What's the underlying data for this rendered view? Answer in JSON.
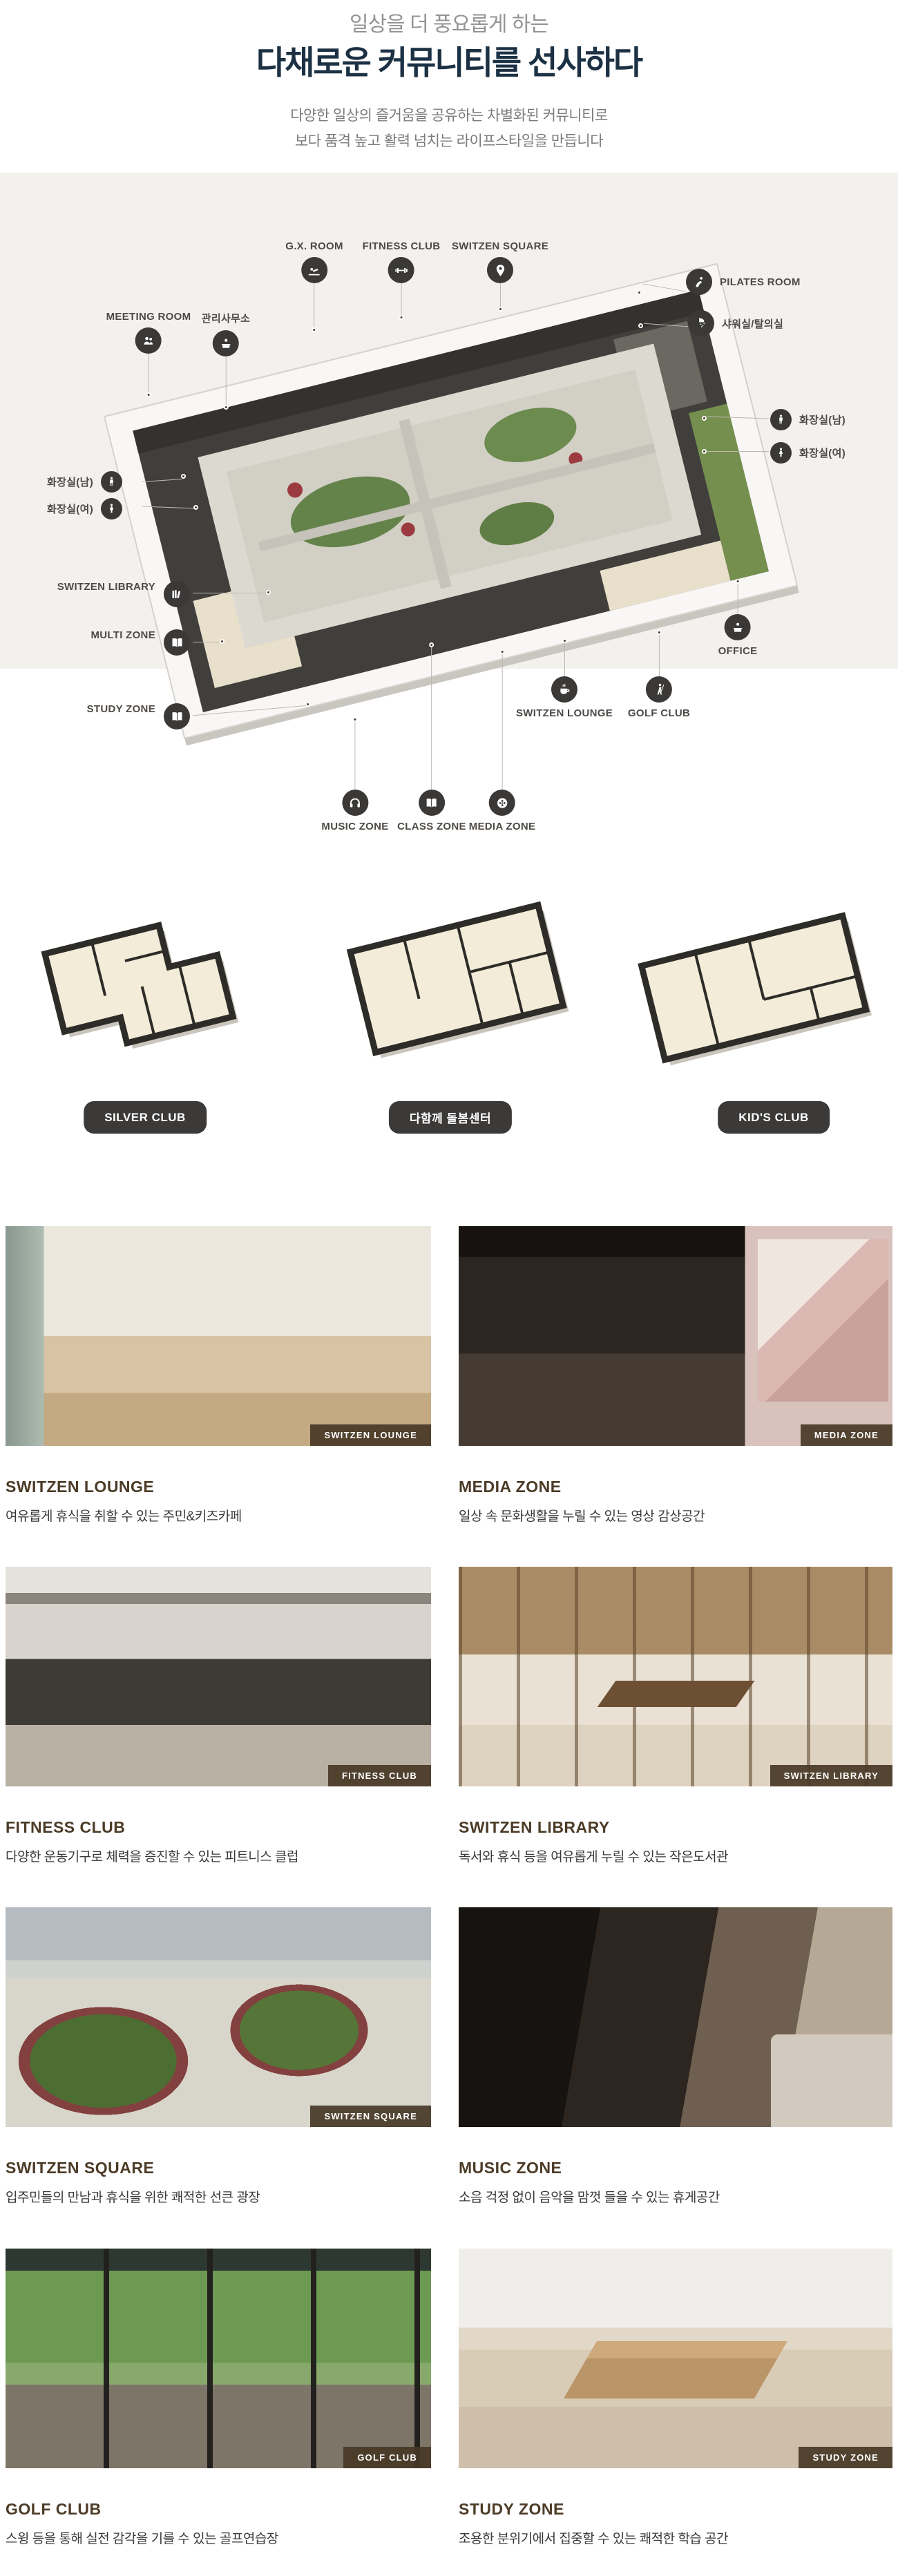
{
  "header": {
    "subtitle": "일상을 더 풍요롭게 하는",
    "title": "다채로운 커뮤니티를 선사하다",
    "description_line1": "다양한 일상의 즐거움을 공유하는 차별화된 커뮤니티로",
    "description_line2": "보다 품격 높고 활력 넘치는 라이프스타일을 만듭니다"
  },
  "colors": {
    "accent_navy": "#1c3144",
    "section_bg": "#f2f1ee",
    "icon_circle": "#3b3937",
    "badge_brown": "#483826",
    "title_brown": "#4c3b27"
  },
  "floorplan": {
    "labels": [
      {
        "text": "G.X. ROOM",
        "icon": "gx-room-icon"
      },
      {
        "text": "FITNESS CLUB",
        "icon": "dumbbell-icon"
      },
      {
        "text": "SWITZEN SQUARE",
        "icon": "location-pin-icon"
      },
      {
        "text": "PILATES ROOM",
        "icon": "pilates-icon"
      },
      {
        "text": "샤워실/탈의실",
        "icon": "shower-icon"
      },
      {
        "text": "MEETING ROOM",
        "icon": "people-icon"
      },
      {
        "text": "관리사무소",
        "icon": "reception-desk-icon"
      },
      {
        "text": "화장실(남)",
        "icon": "male-icon"
      },
      {
        "text": "화장실(여)",
        "icon": "female-icon"
      },
      {
        "text": "화장실(남)",
        "icon": "male-icon"
      },
      {
        "text": "화장실(여)",
        "icon": "female-icon"
      },
      {
        "text": "SWITZEN LIBRARY",
        "icon": "books-icon"
      },
      {
        "text": "MULTI ZONE",
        "icon": "open-book-icon"
      },
      {
        "text": "STUDY ZONE",
        "icon": "open-book-icon"
      },
      {
        "text": "OFFICE",
        "icon": "reception-desk-icon"
      },
      {
        "text": "SWITZEN LOUNGE",
        "icon": "coffee-cup-icon"
      },
      {
        "text": "GOLF CLUB",
        "icon": "golfer-icon"
      },
      {
        "text": "MUSIC ZONE",
        "icon": "headphones-icon"
      },
      {
        "text": "CLASS ZONE",
        "icon": "open-book-icon"
      },
      {
        "text": "MEDIA ZONE",
        "icon": "film-reel-icon"
      }
    ]
  },
  "clubs": [
    {
      "label": "SILVER CLUB"
    },
    {
      "label": "다함께 돌봄센터"
    },
    {
      "label": "KID'S CLUB"
    }
  ],
  "gallery": [
    {
      "badge": "SWITZEN LOUNGE",
      "title": "SWITZEN LOUNGE",
      "desc": "여유롭게 휴식을 취할 수 있는 주민&키즈카페"
    },
    {
      "badge": "MEDIA ZONE",
      "title": "MEDIA ZONE",
      "desc": "일상 속 문화생활을 누릴 수 있는 영상 감상공간"
    },
    {
      "badge": "FITNESS CLUB",
      "title": "FITNESS CLUB",
      "desc": "다양한 운동기구로 체력을 증진할 수 있는 피트니스 클럽"
    },
    {
      "badge": "SWITZEN LIBRARY",
      "title": "SWITZEN LIBRARY",
      "desc": "독서와 휴식 등을 여유롭게 누릴 수 있는 작은도서관"
    },
    {
      "badge": "SWITZEN SQUARE",
      "title": "SWITZEN SQUARE",
      "desc": "입주민들의 만남과 휴식을 위한 쾌적한 선큰 광장"
    },
    {
      "badge": "MUSIC ZONE",
      "title": "MUSIC ZONE",
      "desc": "소음 걱정 없이 음악을 맘껏 들을 수 있는 휴게공간"
    },
    {
      "badge": "GOLF CLUB",
      "title": "GOLF CLUB",
      "desc": "스윙 등을 통해 실전 감각을 기를 수 있는 골프연습장"
    },
    {
      "badge": "STUDY ZONE",
      "title": "STUDY ZONE",
      "desc": "조용한 분위기에서 집중할 수 있는 쾌적한 학습 공간"
    }
  ]
}
